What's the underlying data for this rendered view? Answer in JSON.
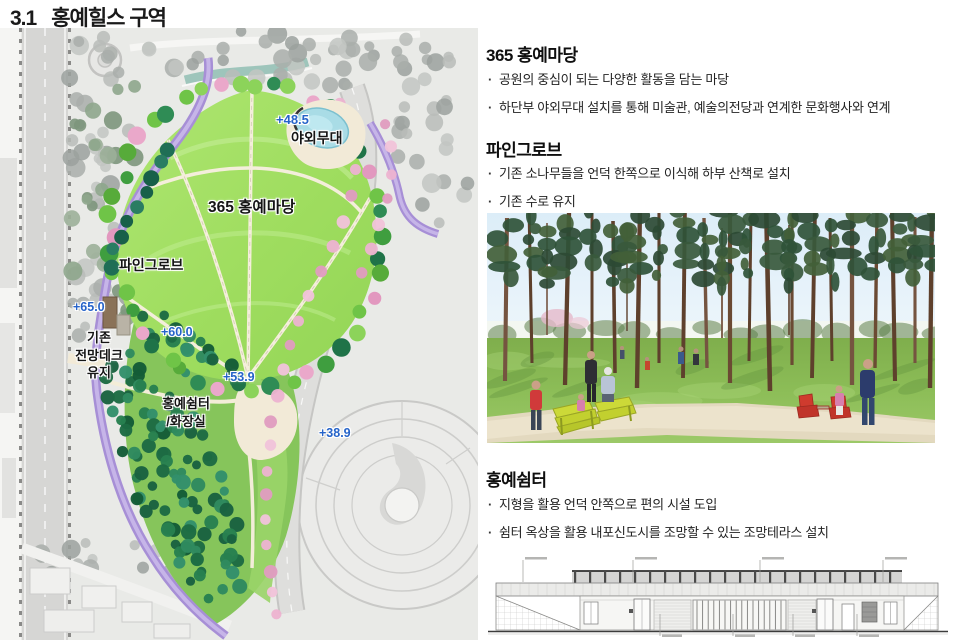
{
  "page": {
    "title_no": "3.1",
    "title": "홍예힐스 구역"
  },
  "map": {
    "labels": {
      "stage_elev": "+48.5",
      "stage": "야외무대",
      "madang": "365 홍예마당",
      "pine": "파인그로브",
      "elev65": "+65.0",
      "deck1": "기존",
      "deck2": "전망데크",
      "deck3": "유지",
      "elev60": "+60.0",
      "elev53": "+53.9",
      "shelter1": "홍예쉼터",
      "shelter2": "/화장실",
      "elev38": "+38.9"
    },
    "colors": {
      "lawn_green": "#a3e066",
      "forest_green": "#1f6b45",
      "path_purple": "#a78fd6",
      "blossom_pink": "#e9a9ca",
      "pond_blue": "#a9dce6",
      "elevation_blue": "#2563c9",
      "road_gray": "#d6d6d4",
      "plaza_cream": "#f2ead7"
    }
  },
  "sections": [
    {
      "heading": "365 홍예마당",
      "bullets": [
        "공원의 중심이 되는 다양한 활동을 담는 마당",
        "하단부 야외무대 설치를 통해 미술관, 예술의전당과 연계한 문화행사와 연계"
      ]
    },
    {
      "heading": "파인그로브",
      "bullets": [
        "기존 소나무들을 언덕 한쪽으로 이식해 하부 산책로 설치",
        "기존 수로 유지"
      ]
    },
    {
      "heading": "홍예쉼터",
      "bullets": [
        "지형을 활용 언덕 안쪽으로 편의 시설 도입",
        "쉼터 옥상을 활용 내포신도시를 조망할 수 있는 조망테라스 설치"
      ]
    }
  ]
}
